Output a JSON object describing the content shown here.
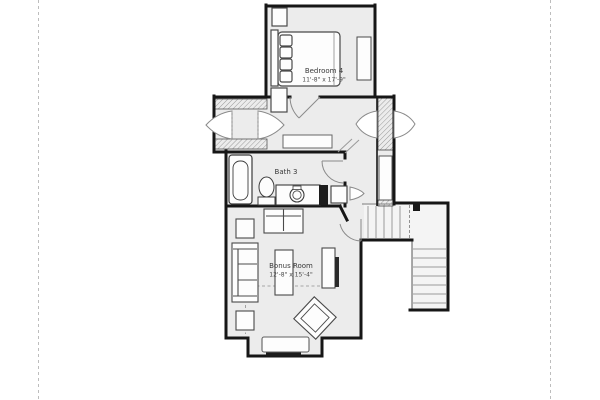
{
  "page": {
    "type": "architectural floor plan sheet",
    "background": "#ffffff",
    "margin_guides": {
      "style": "dashed",
      "color": "#bdbdbd",
      "left_x": 38,
      "right_x": 550
    }
  },
  "floorplan": {
    "rooms": [
      {
        "name": "Bedroom 4",
        "dimensions": "11'-8\" x 17'-9\""
      },
      {
        "name": "Bath 3",
        "dimensions": ""
      },
      {
        "name": "Bonus Room",
        "dimensions": "12'-8\" x 15'-4\""
      }
    ],
    "colors": {
      "wall": "#161616",
      "room_fill": "#ececec",
      "stair_fill": "#f4f4f4",
      "furniture_fill": "#fdfdfd",
      "furniture_stroke": "#4a4a4a",
      "door_stroke": "#8a8a8a",
      "hatch_stroke": "#9a9a9a",
      "label_text": "#3a3a3a"
    },
    "fixture_icons": [
      "bed-icon",
      "nightstand-icon",
      "dresser-icon",
      "closet-shelf-icon",
      "double-door-icon",
      "bathtub-icon",
      "toilet-icon",
      "vanity-sink-icon",
      "linen-closet-icon",
      "stairs-icon",
      "sofa-icon",
      "loveseat-icon",
      "side-table-icon",
      "coffee-table-icon",
      "media-console-icon",
      "accent-chair-icon",
      "window-seat-icon",
      "door-swing-icon"
    ]
  }
}
